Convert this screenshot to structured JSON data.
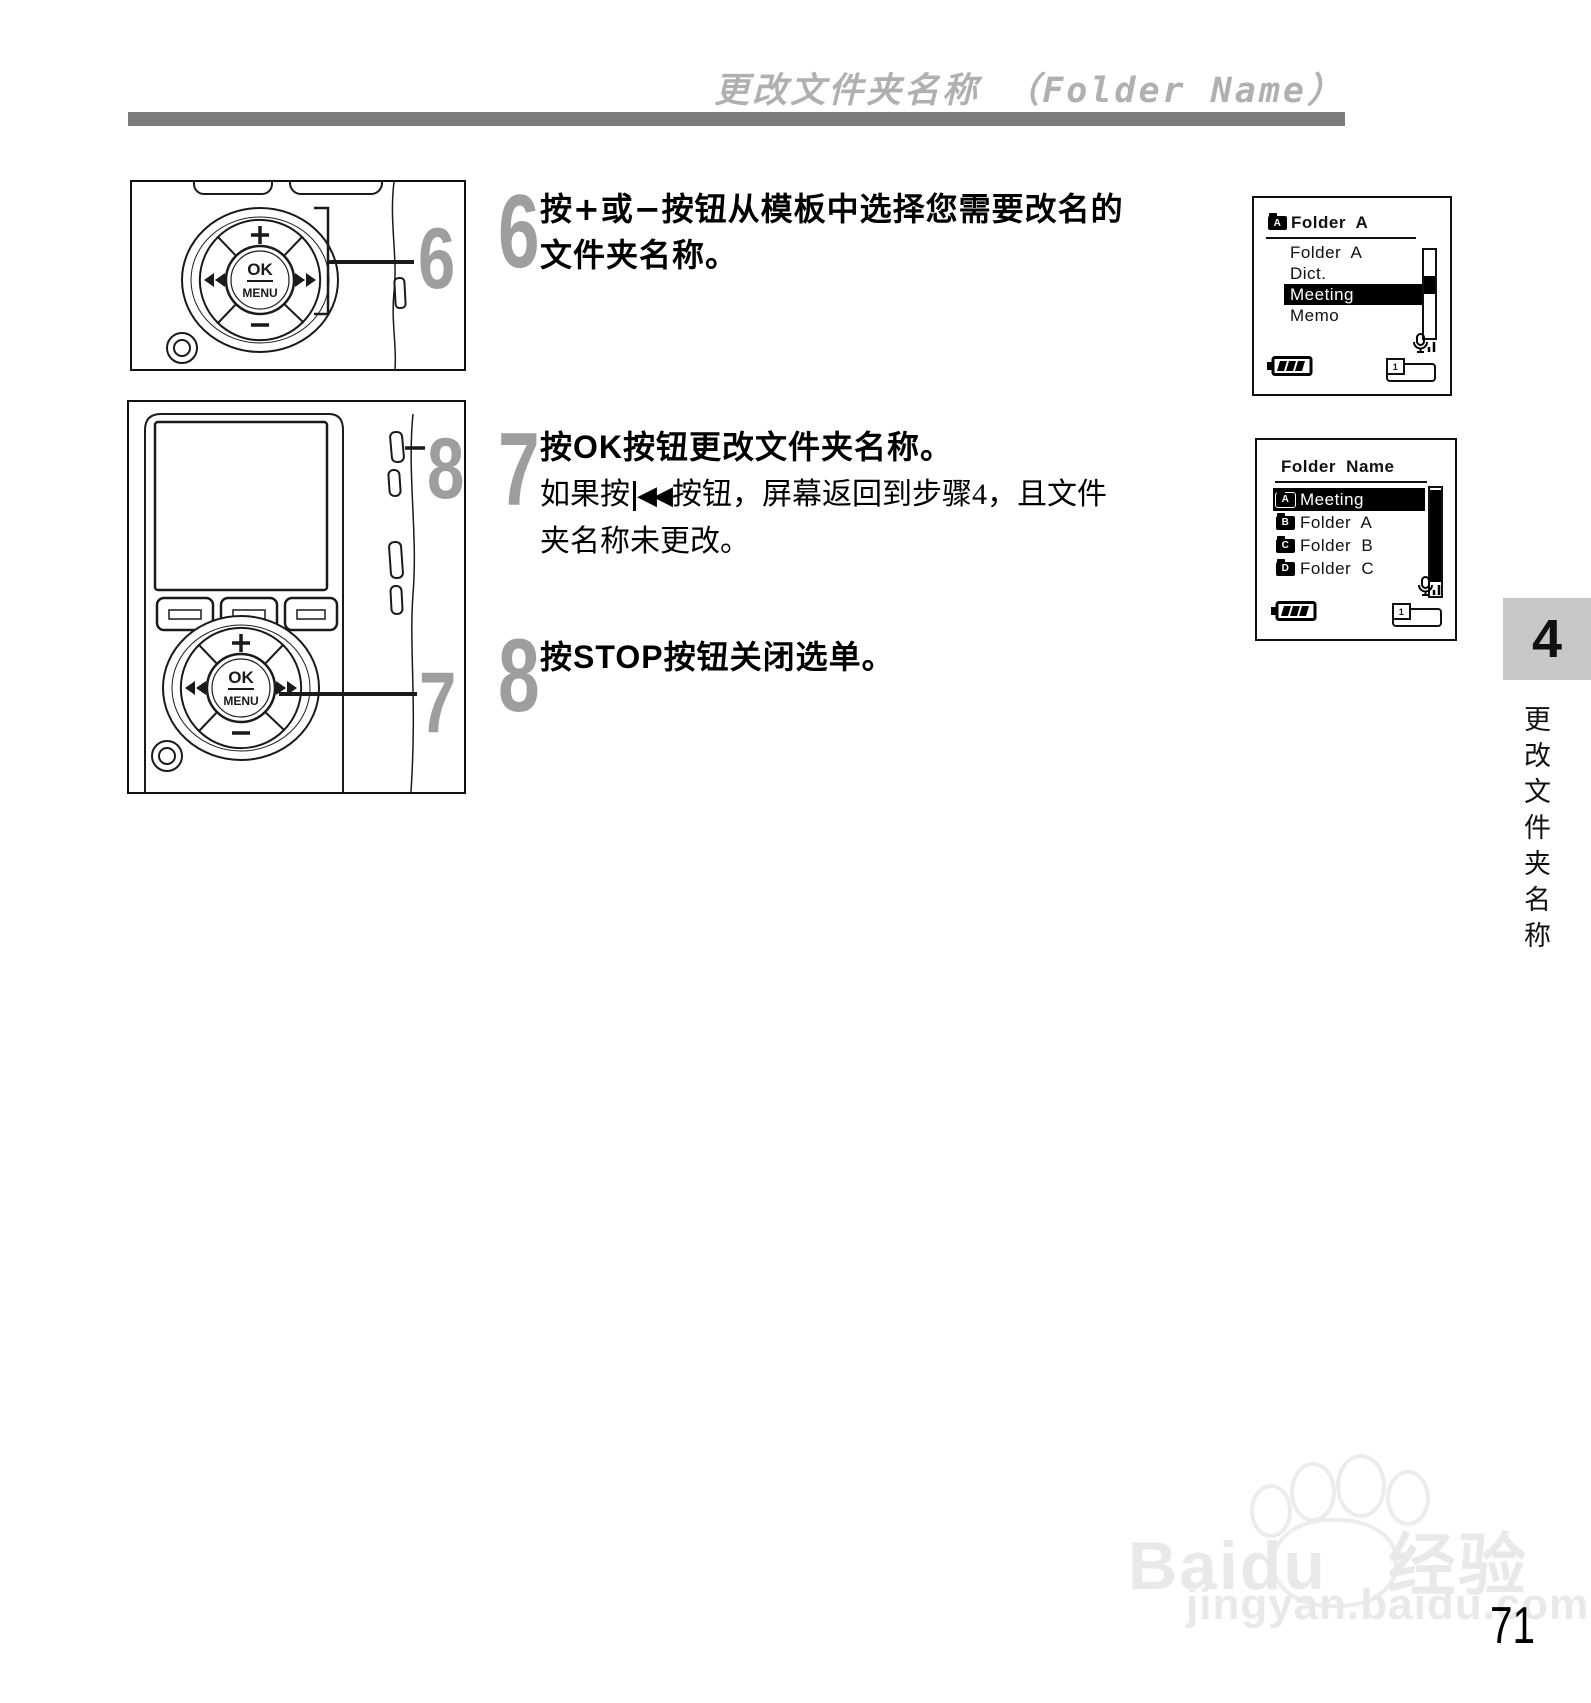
{
  "colors": {
    "title_gray": "#b0b0b0",
    "rule_bar_gray": "#7c7c7c",
    "step_numeral_gray": "#9e9e9e",
    "chapter_tab_gray": "#c8c8c8",
    "ink_black": "#111111"
  },
  "header": {
    "title": "更改文件夹名称 （Folder Name）"
  },
  "steps": {
    "s6": {
      "num": "6",
      "l1_pre": "按",
      "plus": "+",
      "l1_mid": "或",
      "minus": "−",
      "l1_post": "按钮从模板中选择您需要改名的",
      "l2": "文件夹名称。"
    },
    "s7": {
      "num": "7",
      "head_pre": "按",
      "head_key": "OK",
      "head_post": "按钮更改文件夹名称。",
      "sub1_pre": "如果按",
      "rewind": "◀◀",
      "sub1_post": "按钮，屏幕返回到步骤4，且文件",
      "sub2": "夹名称未更改。"
    },
    "s8": {
      "num": "8",
      "head_pre": "按",
      "head_key": "STOP",
      "head_post": "按钮关闭选单。"
    }
  },
  "illustration1": {
    "callout": "6",
    "nav": {
      "plus": "+",
      "minus": "−",
      "ok": "OK",
      "menu": "MENU"
    }
  },
  "illustration2": {
    "callout_top": "8",
    "callout_bottom": "7",
    "nav": {
      "plus": "+",
      "minus": "−",
      "ok": "OK",
      "menu": "MENU"
    }
  },
  "screen1": {
    "header_icon": "A",
    "header_label": "Folder A",
    "items": [
      {
        "label": "Folder A",
        "selected": false
      },
      {
        "label": "Dict.",
        "selected": false
      },
      {
        "label": "Meeting",
        "selected": true
      },
      {
        "label": "Memo",
        "selected": false
      }
    ],
    "card": "1"
  },
  "screen2": {
    "header": "Folder Name",
    "items": [
      {
        "icon": "A",
        "label": "Meeting",
        "selected": true
      },
      {
        "icon": "B",
        "label": "Folder A",
        "selected": false
      },
      {
        "icon": "C",
        "label": "Folder B",
        "selected": false
      },
      {
        "icon": "D",
        "label": "Folder C",
        "selected": false
      }
    ],
    "card": "1"
  },
  "sidebar": {
    "chapter_number": "4",
    "chapter_title": "更改文件夹名称"
  },
  "footer": {
    "watermark_brand": "Baidu",
    "watermark_suffix": "经验",
    "watermark_url": "jingyan.baidu.com",
    "page_number": "71"
  }
}
